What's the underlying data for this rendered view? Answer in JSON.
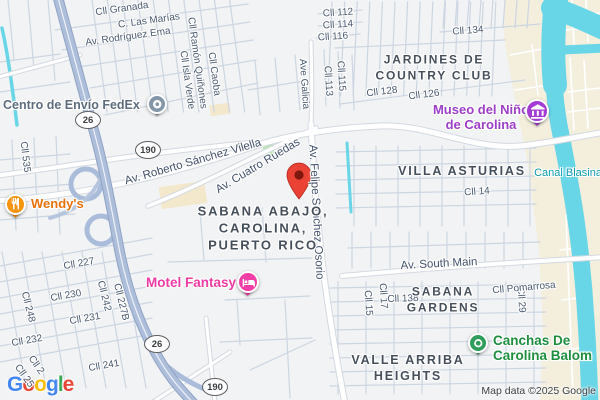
{
  "map": {
    "attribution": "Map data ©2025 Google",
    "logo": {
      "letters": [
        "G",
        "o",
        "o",
        "g",
        "l",
        "e"
      ],
      "colors": [
        "#4285F4",
        "#EA4335",
        "#FBBC05",
        "#4285F4",
        "#34A853",
        "#EA4335"
      ]
    },
    "colors": {
      "land": "#f2f3f4",
      "sand": "#f4eedd",
      "water": "#69d6e7",
      "park": "#b9e5b2",
      "highway": "#adbedb",
      "road": "#ffffff",
      "destination_pin": "#ea4335"
    },
    "shields": [
      {
        "label": "26",
        "x": 88,
        "y": 120
      },
      {
        "label": "190",
        "x": 148,
        "y": 150
      },
      {
        "label": "26",
        "x": 157,
        "y": 344
      },
      {
        "label": "190",
        "x": 215,
        "y": 387
      }
    ],
    "street_labels": [
      {
        "text": "Cll Granada",
        "x": 122,
        "y": 9,
        "rot": -8
      },
      {
        "text": "C. Las Marías",
        "x": 149,
        "y": 21,
        "rot": -8
      },
      {
        "text": "Av. Rodríguez Ema",
        "x": 128,
        "y": 37,
        "rot": -8
      },
      {
        "text": "Cll Ramón Quiñones",
        "x": 197,
        "y": 63,
        "rot": 82
      },
      {
        "text": "Cll Isla Verde",
        "x": 187,
        "y": 80,
        "rot": 82
      },
      {
        "text": "Cll Caoba",
        "x": 214,
        "y": 74,
        "rot": 82
      },
      {
        "text": "Cll 535",
        "x": 25,
        "y": 157,
        "rot": 83
      },
      {
        "text": "Cll 112",
        "x": 338,
        "y": 13,
        "rot": -4
      },
      {
        "text": "Cll 114",
        "x": 338,
        "y": 25,
        "rot": -4
      },
      {
        "text": "Cll 116",
        "x": 333,
        "y": 37,
        "rot": -4
      },
      {
        "text": "Cll 134",
        "x": 468,
        "y": 31,
        "rot": -4
      },
      {
        "text": "Ave Galicia",
        "x": 304,
        "y": 84,
        "rot": 86
      },
      {
        "text": "Cll 115",
        "x": 341,
        "y": 76,
        "rot": 86
      },
      {
        "text": "Cll 113",
        "x": 328,
        "y": 81,
        "rot": 86
      },
      {
        "text": "Cll 128",
        "x": 382,
        "y": 92,
        "rot": -7
      },
      {
        "text": "Cll 126",
        "x": 424,
        "y": 95,
        "rot": -7
      },
      {
        "text": "Av. Roberto Sánchez Vilella",
        "x": 193,
        "y": 162,
        "rot": -16,
        "major": true
      },
      {
        "text": "Av. Cuatro Ruedas",
        "x": 258,
        "y": 166,
        "rot": -31,
        "major": true
      },
      {
        "text": "Av. Felipe Sánchez Osorio",
        "x": 316,
        "y": 212,
        "rot": 87,
        "major": true
      },
      {
        "text": "Cll 14",
        "x": 477,
        "y": 192,
        "rot": -4
      },
      {
        "text": "Canal Blasina",
        "x": 568,
        "y": 173,
        "rot": 0,
        "water": true
      },
      {
        "text": "Cll 15",
        "x": 368,
        "y": 303,
        "rot": 86
      },
      {
        "text": "Cll 17",
        "x": 383,
        "y": 296,
        "rot": 86
      },
      {
        "text": "Cll 29",
        "x": 521,
        "y": 300,
        "rot": 86
      },
      {
        "text": "Av. South Main",
        "x": 439,
        "y": 264,
        "rot": -3,
        "major": true
      },
      {
        "text": "Cll 138",
        "x": 403,
        "y": 299,
        "rot": -2
      },
      {
        "text": "Cll Pomarrosa",
        "x": 524,
        "y": 288,
        "rot": -5
      },
      {
        "text": "Cll 227",
        "x": 79,
        "y": 264,
        "rot": -10
      },
      {
        "text": "Cll 230",
        "x": 66,
        "y": 296,
        "rot": -10
      },
      {
        "text": "Cll 231",
        "x": 85,
        "y": 319,
        "rot": -10
      },
      {
        "text": "Cll 242",
        "x": 104,
        "y": 296,
        "rot": 76
      },
      {
        "text": "Cll 227B",
        "x": 121,
        "y": 302,
        "rot": 76
      },
      {
        "text": "Cll 248",
        "x": 28,
        "y": 307,
        "rot": 76
      },
      {
        "text": "Cll 232",
        "x": 27,
        "y": 341,
        "rot": -10
      },
      {
        "text": "Cll 241",
        "x": 104,
        "y": 366,
        "rot": -10
      },
      {
        "text": "Cll 2",
        "x": 36,
        "y": 365,
        "rot": 55
      },
      {
        "text": "Cll 25",
        "x": 24,
        "y": 376,
        "rot": 55
      }
    ],
    "area_labels": [
      {
        "lines": [
          "JARDINES DE",
          "COUNTRY CLUB"
        ],
        "x": 434,
        "y": 68,
        "size": 12
      },
      {
        "lines": [
          "VILLA ASTURIAS"
        ],
        "x": 462,
        "y": 171,
        "size": 12.5
      },
      {
        "lines": [
          "SABANA ABAJO,",
          "CAROLINA,",
          "PUERTO RICO"
        ],
        "x": 263,
        "y": 229,
        "size": 13
      },
      {
        "lines": [
          "SABANA",
          "GARDENS"
        ],
        "x": 443,
        "y": 300,
        "size": 12
      },
      {
        "lines": [
          "VALLE ARRIBA",
          "HEIGHTS"
        ],
        "x": 408,
        "y": 368,
        "size": 12.5
      }
    ],
    "pois": [
      {
        "id": "fedex",
        "lines": [
          "Centro de Envío FedEx"
        ],
        "x": 3,
        "y": 98,
        "align": "left",
        "color": "#5d6d7e",
        "size": 12.5,
        "marker": {
          "x": 157,
          "y": 104,
          "color": "#8296a8",
          "icon": "package-icon",
          "d": 20
        }
      },
      {
        "id": "wendys",
        "lines": [
          "Wendy's"
        ],
        "x": 31,
        "y": 197,
        "align": "left",
        "color": "#e8710a",
        "size": 13,
        "marker": {
          "x": 15,
          "y": 204,
          "color": "#f6930f",
          "icon": "restaurant-icon",
          "d": 21
        }
      },
      {
        "id": "motel",
        "lines": [
          "Motel Fantasy"
        ],
        "x": 146,
        "y": 275,
        "align": "left",
        "color": "#ec3ca3",
        "size": 13.5,
        "marker": {
          "x": 248,
          "y": 282,
          "color": "#f23da6",
          "icon": "bed-icon",
          "d": 22
        }
      },
      {
        "id": "museo",
        "lines": [
          "Museo del Niño",
          "de Carolina"
        ],
        "x": 481,
        "y": 103,
        "align": "center",
        "color": "#9d3fc9",
        "size": 13,
        "marker": {
          "x": 537,
          "y": 111,
          "color": "#a43bd4",
          "icon": "museum-icon",
          "d": 24
        }
      },
      {
        "id": "canchas",
        "lines": [
          "Canchas De",
          "Carolina Balom"
        ],
        "x": 493,
        "y": 333,
        "align": "left",
        "color": "#1e8e3e",
        "size": 13.5,
        "marker": {
          "x": 478,
          "y": 343,
          "color": "#2f9e5b",
          "icon": "sports-icon",
          "d": 20
        }
      }
    ],
    "destination_pin": {
      "x": 299,
      "y": 199
    }
  }
}
